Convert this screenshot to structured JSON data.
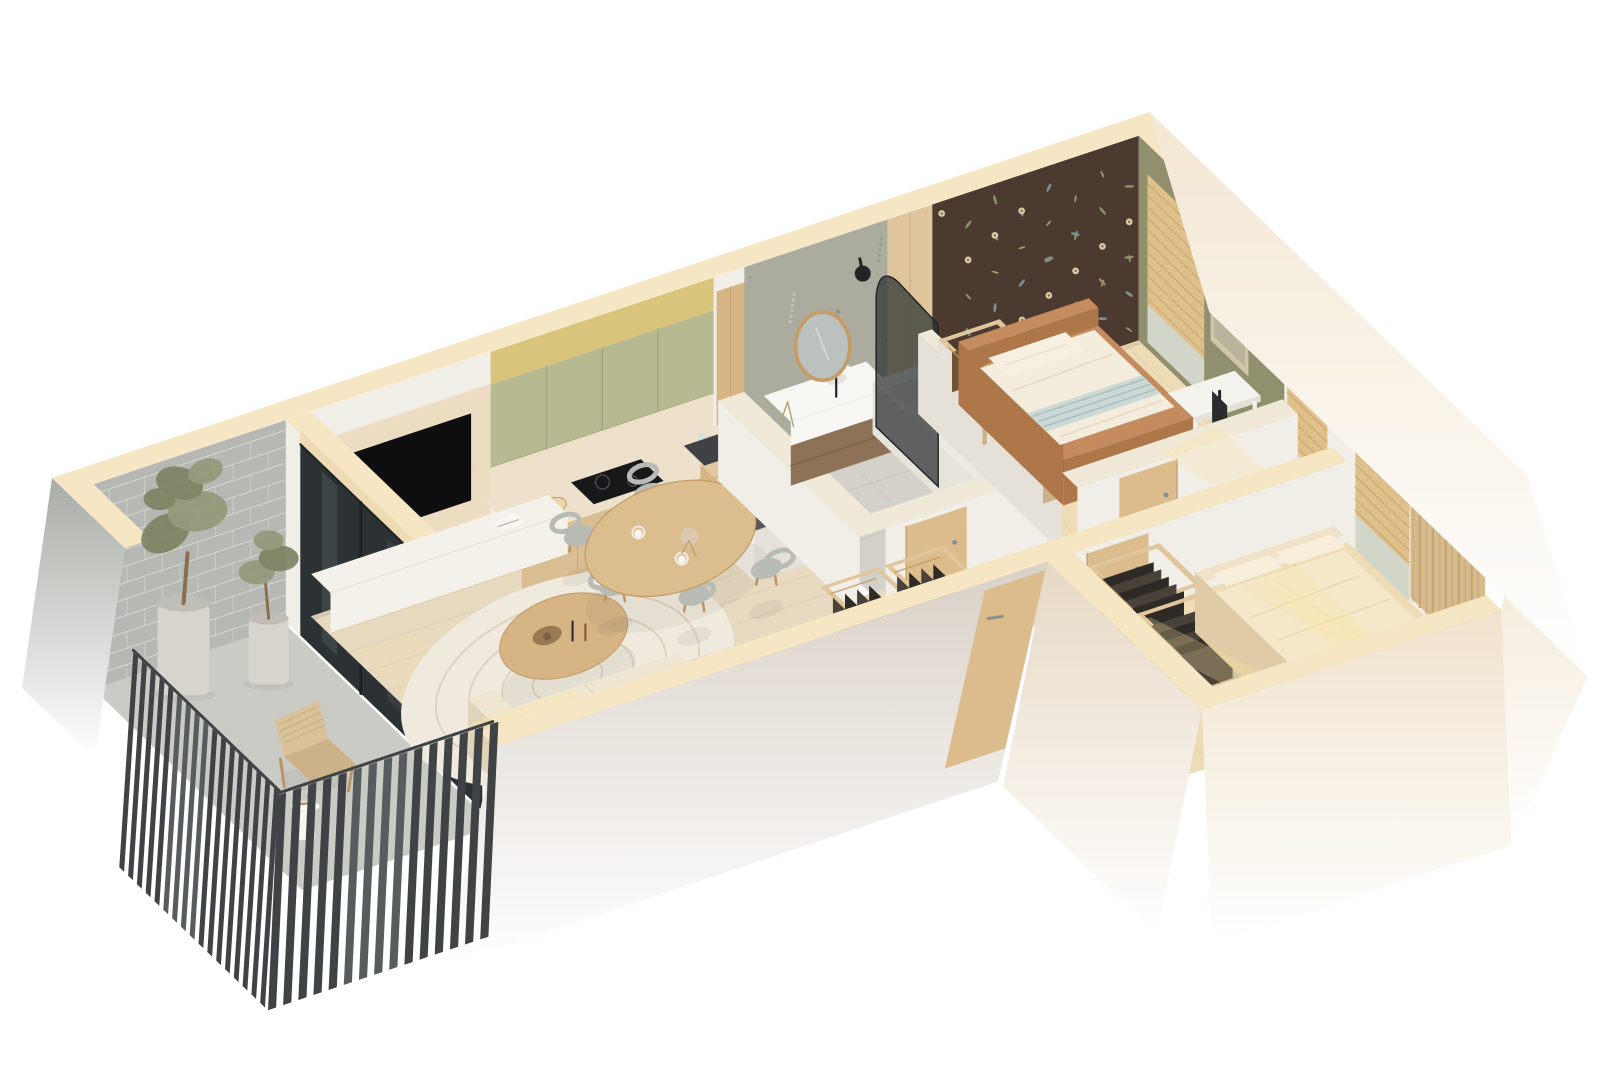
{
  "scene": {
    "type": "isometric-3d-floor-plan-render",
    "description": "Cutaway 3D floor plan of a one-bedroom-plus-studio apartment with balcony, rendered on a white background",
    "rooms": [
      {
        "id": "balcony",
        "label": "Balcony",
        "features": [
          "grey brick wall",
          "dark slatted railing",
          "two potted olive trees",
          "wicker lounge chair",
          "round side table",
          "sliding glass door"
        ]
      },
      {
        "id": "living-room",
        "label": "Living room",
        "features": [
          "wall-mounted TV on marble panel",
          "low white media console",
          "cream sofa",
          "patterned area rug",
          "oval wooden coffee table",
          "round dining table with six chairs"
        ]
      },
      {
        "id": "kitchen",
        "label": "Kitchen",
        "features": [
          "sage green upper cabinets with under-cabinet lighting",
          "marble backsplash and countertop",
          "black induction hob",
          "built-in black oven",
          "light wood base cabinets",
          "island with dark sink and faucet"
        ]
      },
      {
        "id": "bathroom",
        "label": "Bathroom",
        "features": [
          "terrazzo feature wall",
          "round wood-framed mirror",
          "white vanity with dark wood drawers",
          "white bathtub",
          "smoked glass arched shower screen",
          "black shower head",
          "wood door"
        ]
      },
      {
        "id": "bedroom",
        "label": "Bedroom",
        "features": [
          "dark brown floral accent wallpaper",
          "olive green wall with framed art",
          "camel upholstered bed with white bedding and striped throw",
          "open wardrobe boxes with hanging clothes",
          "white desk with monitor and chair",
          "window with wooden blinds"
        ]
      },
      {
        "id": "hallway",
        "label": "Hallway",
        "features": [
          "open closets with hanging clothes",
          "entrance door",
          "wood doors to rooms",
          "window with wooden blinds"
        ]
      },
      {
        "id": "master-bedroom",
        "label": "Master bedroom",
        "features": [
          "large double bed with beige bedding",
          "open wardrobes with dark hanging clothes",
          "window with wooden blinds",
          "floor-length tan curtains",
          "sage rug",
          "warm sunlight streaks"
        ]
      }
    ]
  },
  "palette": {
    "bg": "#ffffff",
    "creamTop": "#f6e6c3",
    "creamTopShade": "#eedbb4",
    "innerBand": "#f1e9d8",
    "outerGreige": "#d9d1c7",
    "outerWingSW": "#e6d8c4",
    "outerWingSE": "#f0e3cd",
    "outerEnd": "#f3e7d3",
    "brickOuter": "#a9aca6",
    "whiteWall": "#f1eee8",
    "whiteWallShade": "#e5e1d9",
    "floorWood": "#e8dac1",
    "floorWoodLine": "#d6c5a7",
    "floorWarm": "#eedcb6",
    "floorWarmLine": "#dcc699",
    "bathFloor": "#d3d1c9",
    "bathFloorLine": "#c1bfb5",
    "balconyFloor": "#cbcbc6",
    "brick": "#b6b9b3",
    "brickLine": "#d7d9d4",
    "slat": "#3f4346",
    "slatLight": "#575c5f",
    "glassDark": "#2c3133",
    "glassReflect": "#5a6366",
    "frameDark": "#1e2224",
    "marble": "#ecdcc2",
    "marbleVein": "#dcc5a2",
    "tvBlack": "#0e0e10",
    "consoleWhite": "#f4f1ea",
    "consoleShade": "#e9e5dc",
    "sofaCream": "#efe6d2",
    "sofaShade": "#e0d3ba",
    "sunSoft": "rgba(250,228,160,0.55)",
    "sunStrong": "rgba(252,232,164,0.8)",
    "rugBase": "#f0eade",
    "rugLine": "#d9cfba",
    "woodMid": "#d7b484",
    "woodDark": "#c09a68",
    "tableWood": "#dcbd8d",
    "chairGrey": "#b9bcb4",
    "chairWood": "#bc9465",
    "cabGreen": "#b7ba91",
    "cabGreenDark": "#a3a67c",
    "soffit": "#d9c47b",
    "glow": "#f7f0c8",
    "counter": "#ede1cc",
    "baseCab": "#dabe93",
    "hob": "#17181a",
    "hobRing": "#44464b",
    "ovenDark": "#202123",
    "steel": "#9aa0a3",
    "islandWood": "#e1c89e",
    "islandDark": "#55585a",
    "sinkDark": "#3f4244",
    "terrazzo": "#abab9e",
    "terrSpeck1": "#c7c4b6",
    "terrSpeck2": "#8f8f82",
    "mirrorWood": "#c69c64",
    "mirrorGlass": "#bac1be",
    "vanityWood": "#8d7258",
    "pureWhite": "#f7f6f2",
    "tub": "#f4f3ee",
    "tubShade": "#e5e3da",
    "showerGlass": "rgba(42,47,48,0.72)",
    "black": "#222426",
    "doorWood": "#dcbc8c",
    "doorWoodDark": "#c6a26d",
    "handle": "#8a8f92",
    "floralBase": "#4c3a31",
    "flCream": "#d9c9a4",
    "flCenter": "#8a6b4f",
    "flBlue": "#7c9397",
    "flGreen": "#8e9469",
    "flStem": "#b7a67a",
    "olive": "#90906e",
    "artFrame": "#cfc5a8",
    "artInner": "#b9b49b",
    "blind": "#ddbb87",
    "blindLine": "#b5945e",
    "glassPane": "#ccd4d0",
    "curtain": "#d7bb8d",
    "curtainDark": "#c2a372",
    "rod": "#7f8487",
    "bedCamel": "#c38b5e",
    "bedCamelDark": "#ad7749",
    "duvet": "#f4ecdc",
    "duvetLine": "#e4d7c0",
    "pillowWhite": "#f7f0e1",
    "throw": "#ccd8d5",
    "throwLine": "#9fb5b7",
    "deskWhite": "#f4f2ec",
    "monitor": "#2b2c2e",
    "clothesDark": "#2e2a25",
    "clothesMid": "#4a423a",
    "clothesBrown": "#6f5338",
    "closetWood": "#dfc69c",
    "closetInner": "#cbb186",
    "masterFrame": "#efe2c8",
    "masterFrameDark": "#dfcba6",
    "masterDuvet": "#f4e7ca",
    "masterPillow": "#f7efd9",
    "rugSage": "#b9b7a2",
    "potGrey": "#d6d4cd",
    "potShade": "#bfbdb5",
    "treeGreen": "#7e8565",
    "treeGreen2": "#949a7b",
    "trunk": "#8a6f4e",
    "wicker": "#d9c29a",
    "wickerShade": "#cbb288",
    "shadowSoft": "rgba(110,100,85,0.18)"
  }
}
